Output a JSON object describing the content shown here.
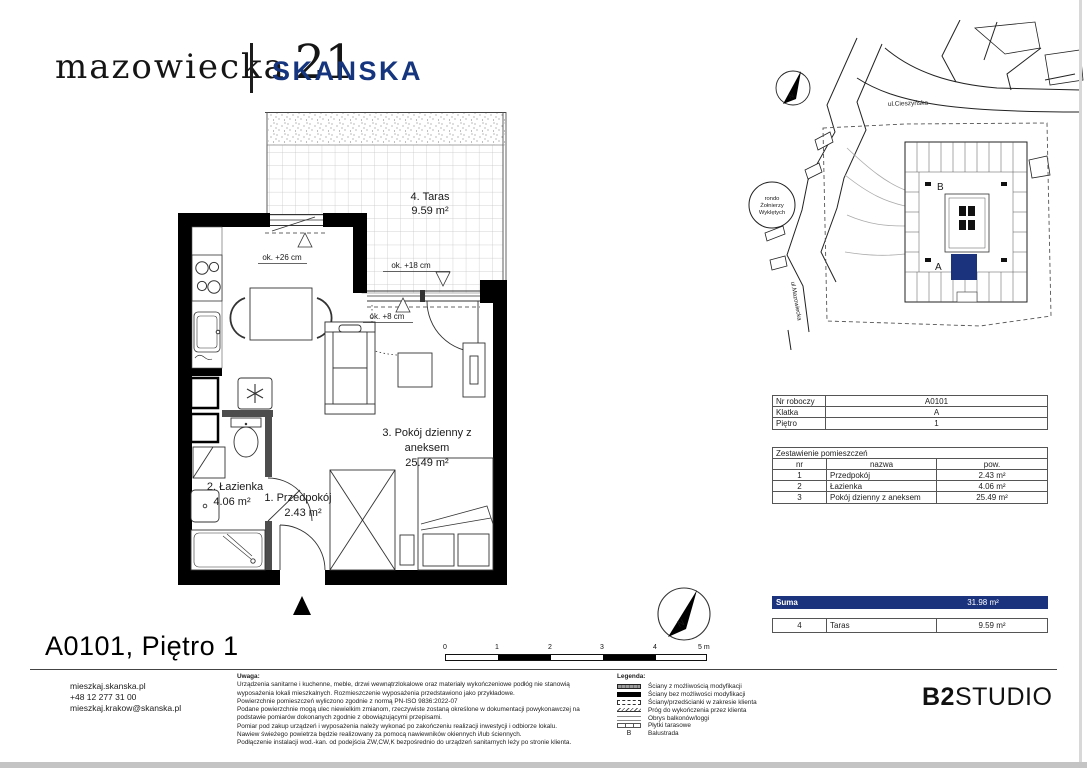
{
  "header": {
    "brand_name": "mazowiecka",
    "brand_number": "21",
    "developer": "SKANSKA"
  },
  "colors": {
    "accent_navy": "#1b327d",
    "skanska_navy": "#15357e"
  },
  "plan": {
    "terrace_label": "4. Taras",
    "terrace_area": "9.59 m²",
    "living_label_line1": "3. Pokój dzienny z",
    "living_label_line2": "aneksem",
    "living_area": "25.49 m²",
    "bathroom_label": "2. Łazienka",
    "bathroom_area": "4.06 m²",
    "hall_label": "1. Przedpokój",
    "hall_area": "2.43 m²",
    "level_kitchen_window": "ok. +26 cm",
    "level_terrace_window": "ok. +18 cm",
    "level_terrace_door": "ok. +8 cm"
  },
  "site_map": {
    "street_top": "ul.Cieszyńska",
    "street_left": "ul.Mazowiecka",
    "roundabout_line1": "rondo",
    "roundabout_line2": "Żołnierzy",
    "roundabout_line3": "Wyklętych",
    "building_b": "B",
    "building_a": "A",
    "compass_n": "N"
  },
  "info_table": {
    "rows": [
      {
        "label": "Nr roboczy",
        "value": "A0101"
      },
      {
        "label": "Klatka",
        "value": "A"
      },
      {
        "label": "Piętro",
        "value": "1"
      }
    ]
  },
  "rooms_table": {
    "title": "Zestawienie pomieszczeń",
    "columns": [
      "nr",
      "nazwa",
      "pow."
    ],
    "rows": [
      [
        "1",
        "Przedpokój",
        "2.43 m²"
      ],
      [
        "2",
        "Łazienka",
        "4.06 m²"
      ],
      [
        "3",
        "Pokój dzienny z aneksem",
        "25.49 m²"
      ]
    ]
  },
  "summary": {
    "label": "Suma",
    "value": "31.98 m²"
  },
  "terrace_row": {
    "nr": "4",
    "name": "Taras",
    "area": "9.59 m²"
  },
  "scale_bar": {
    "t0": "0",
    "t1": "1",
    "t2": "2",
    "t3": "3",
    "t4": "4",
    "t5": "5 m"
  },
  "compass": {
    "n": "N"
  },
  "footer": {
    "title": "A0101, Piętro 1",
    "contact_web": "mieszkaj.skanska.pl",
    "contact_phone": "+48 12 277 31 00",
    "contact_email": "mieszkaj.krakow@skanska.pl",
    "note_title": "Uwaga:",
    "notes": [
      "Urządzenia sanitarne i kuchenne, meble, drzwi wewnątrzlokalowe oraz materiały wykończeniowe podłóg nie stanowią wyposażenia lokali mieszkalnych. Rozmieszczenie wyposażenia przedstawiono jako przykładowe.",
      "Powierzchnie pomieszczeń wyliczono zgodnie z normą PN-ISO 9836:2022-07",
      "Podane powierzchnie mogą ulec niewielkim zmianom, rzeczywiste zostaną określone w dokumentacji powykonawczej na podstawie pomiarów dokonanych zgodnie z obowiązującymi przepisami.",
      "Pomiar pod zakup urządzeń i wyposażenia należy wykonać po zakończeniu realizacji inwestycji i odbiorze lokalu.",
      "Nawiew świeżego powietrza będzie realizowany za pomocą nawiewników okiennych i/lub ściennych.",
      "Podłączenie instalacji wod.-kan. od podejścia ZW,CW,K bezpośrednio do urządzeń sanitarnych leży po stronie klienta."
    ],
    "legend_title": "Legenda:",
    "legend": [
      {
        "label": "Ściany z możliwością modyfikacji"
      },
      {
        "label": "Ściany bez możliwości modyfikacji"
      },
      {
        "label": "Ściany/przedścianki w zakresie klienta"
      },
      {
        "label": "Próg do wykończenia przez klienta"
      },
      {
        "label": "Obrys balkonów/loggi"
      },
      {
        "label": "Płytki tarasowe"
      },
      {
        "symbol": "B",
        "label": "Balustrada"
      }
    ],
    "studio_bold": "B2",
    "studio_rest": "STUDIO"
  }
}
